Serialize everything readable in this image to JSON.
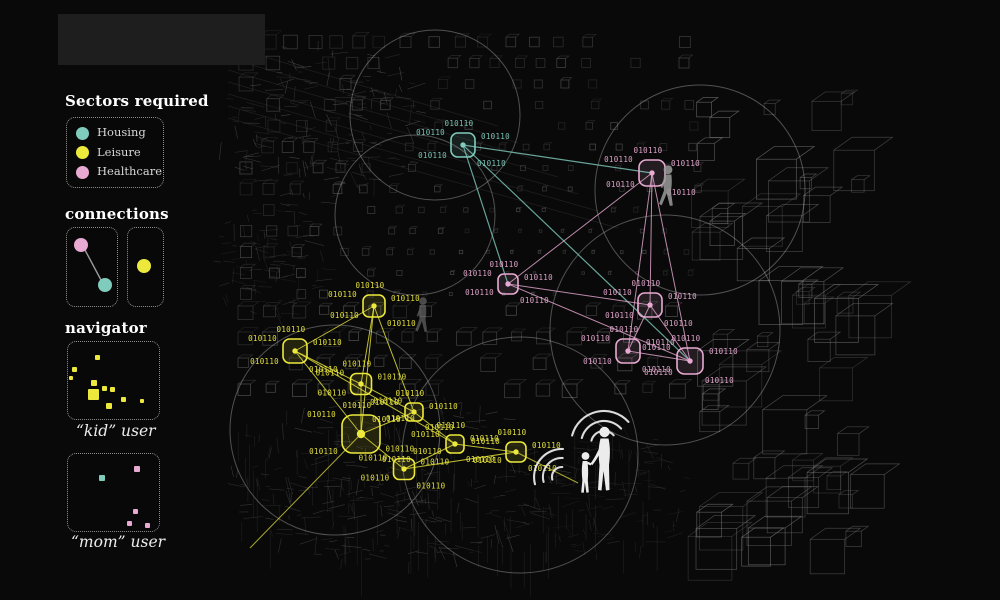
{
  "colors": {
    "housing": "#7fccbd",
    "leisure": "#ece93c",
    "healthcare": "#e8aad2",
    "background": "#090909",
    "panel": "#1e1e1e",
    "wire_dim": "#555555",
    "wire_mid": "#6a6a6a",
    "wire_bright": "#848484",
    "circle": "#c9c9c9",
    "silhouette_gray": "#9b9b9b",
    "silhouette_white": "#f4f4f4"
  },
  "sidebar": {
    "sectors_title": "Sectors required",
    "sectors": [
      {
        "label": "Housing",
        "sector": "housing"
      },
      {
        "label": "Leisure",
        "sector": "leisure"
      },
      {
        "label": "Healthcare",
        "sector": "healthcare"
      }
    ],
    "connections_title": "connections",
    "connection_examples": [
      {
        "dots": [
          {
            "sector": "healthcare",
            "x": 14,
            "y": 17
          },
          {
            "sector": "housing",
            "x": 38,
            "y": 57
          }
        ],
        "linked": true
      },
      {
        "dots": [
          {
            "sector": "leisure",
            "x": 16,
            "y": 38
          }
        ],
        "linked": false
      }
    ],
    "navigator_title": "navigator",
    "kid_label": "“kid” user",
    "mom_label": "“mom” user",
    "kid_minimap": [
      [
        27,
        13,
        5
      ],
      [
        4,
        25,
        5
      ],
      [
        1,
        34,
        4
      ],
      [
        23,
        38,
        6
      ],
      [
        34,
        44,
        5
      ],
      [
        42,
        45,
        5
      ],
      [
        20,
        47,
        11
      ],
      [
        38,
        61,
        6
      ],
      [
        53,
        55,
        5
      ],
      [
        72,
        57,
        4
      ]
    ],
    "mom_minimap": [
      [
        31,
        21,
        6,
        "housing"
      ],
      [
        66,
        12,
        6,
        "healthcare"
      ],
      [
        65,
        55,
        5,
        "healthcare"
      ],
      [
        59,
        67,
        5,
        "healthcare"
      ],
      [
        77,
        69,
        5,
        "healthcare"
      ]
    ]
  },
  "network": {
    "binary_label": "010110",
    "nodes": [
      {
        "id": "T1",
        "sector": "housing",
        "x": 463,
        "y": 145,
        "size": 24
      },
      {
        "id": "P1",
        "sector": "healthcare",
        "x": 652,
        "y": 173,
        "size": 26
      },
      {
        "id": "P2",
        "sector": "healthcare",
        "x": 508,
        "y": 284,
        "size": 20
      },
      {
        "id": "P3",
        "sector": "healthcare",
        "x": 650,
        "y": 305,
        "size": 24
      },
      {
        "id": "P4",
        "sector": "healthcare",
        "x": 628,
        "y": 351,
        "size": 24
      },
      {
        "id": "P5",
        "sector": "healthcare",
        "x": 690,
        "y": 361,
        "size": 26
      },
      {
        "id": "Y1",
        "sector": "leisure",
        "x": 374,
        "y": 306,
        "size": 22
      },
      {
        "id": "Y2",
        "sector": "leisure",
        "x": 295,
        "y": 351,
        "size": 24
      },
      {
        "id": "Y3",
        "sector": "leisure",
        "x": 361,
        "y": 384,
        "size": 21
      },
      {
        "id": "Y4",
        "sector": "leisure",
        "x": 414,
        "y": 412,
        "size": 18
      },
      {
        "id": "Y5",
        "sector": "leisure",
        "x": 361,
        "y": 434,
        "size": 38
      },
      {
        "id": "Y6",
        "sector": "leisure",
        "x": 455,
        "y": 444,
        "size": 18
      },
      {
        "id": "Y7",
        "sector": "leisure",
        "x": 404,
        "y": 469,
        "size": 21
      },
      {
        "id": "Y8",
        "sector": "leisure",
        "x": 516,
        "y": 452,
        "size": 20
      }
    ],
    "edges": [
      {
        "a": "T1",
        "b": "P1",
        "sector": "housing"
      },
      {
        "a": "T1",
        "b": "P2",
        "sector": "housing"
      },
      {
        "a": "T1",
        "b": "P5",
        "sector": "housing"
      },
      {
        "a": "P1",
        "b": "P2",
        "sector": "healthcare"
      },
      {
        "a": "P1",
        "b": "P3",
        "sector": "healthcare"
      },
      {
        "a": "P1",
        "b": "P4",
        "sector": "healthcare"
      },
      {
        "a": "P1",
        "b": "P5",
        "sector": "healthcare"
      },
      {
        "a": "P2",
        "b": "P3",
        "sector": "healthcare"
      },
      {
        "a": "P2",
        "b": "P5",
        "sector": "healthcare"
      },
      {
        "a": "P3",
        "b": "P4",
        "sector": "healthcare"
      },
      {
        "a": "P3",
        "b": "P5",
        "sector": "healthcare"
      },
      {
        "a": "P4",
        "b": "P5",
        "sector": "healthcare"
      },
      {
        "a": "Y1",
        "b": "Y2",
        "sector": "leisure"
      },
      {
        "a": "Y1",
        "b": "Y3",
        "sector": "leisure"
      },
      {
        "a": "Y1",
        "b": "Y4",
        "sector": "leisure"
      },
      {
        "a": "Y1",
        "b": "Y5",
        "sector": "leisure"
      },
      {
        "a": "Y2",
        "b": "Y3",
        "sector": "leisure"
      },
      {
        "a": "Y2",
        "b": "Y5",
        "sector": "leisure"
      },
      {
        "a": "Y2",
        "b": "Y6",
        "sector": "leisure"
      },
      {
        "a": "Y3",
        "b": "Y4",
        "sector": "leisure"
      },
      {
        "a": "Y3",
        "b": "Y5",
        "sector": "leisure"
      },
      {
        "a": "Y4",
        "b": "Y5",
        "sector": "leisure"
      },
      {
        "a": "Y4",
        "b": "Y6",
        "sector": "leisure"
      },
      {
        "a": "Y5",
        "b": "Y7",
        "sector": "leisure"
      },
      {
        "a": "Y6",
        "b": "Y7",
        "sector": "leisure"
      },
      {
        "a": "Y6",
        "b": "Y8",
        "sector": "leisure"
      },
      {
        "a": "Y7",
        "b": "Y8",
        "sector": "leisure"
      }
    ],
    "stray_lines": [
      {
        "sector": "leisure",
        "x1": 361,
        "y1": 434,
        "x2": 250,
        "y2": 548
      },
      {
        "sector": "leisure",
        "x1": 516,
        "y1": 452,
        "x2": 578,
        "y2": 483
      }
    ]
  },
  "scene": {
    "figures": [
      {
        "type": "walking-person",
        "x": 668,
        "y": 207,
        "scale": 1.05,
        "tone": "gray"
      },
      {
        "type": "walking-person",
        "x": 423,
        "y": 333,
        "scale": 0.9,
        "tone": "faint"
      },
      {
        "type": "adult-and-child",
        "x": 597,
        "y": 495,
        "scale": 1,
        "tone": "white"
      }
    ],
    "sound_waves": [
      {
        "x": 604,
        "y": 444,
        "radii": [
          13,
          23,
          33
        ],
        "from": 195,
        "to": 318
      },
      {
        "x": 562,
        "y": 477,
        "radii": [
          10,
          19,
          28
        ],
        "from": 165,
        "to": 272
      }
    ]
  }
}
